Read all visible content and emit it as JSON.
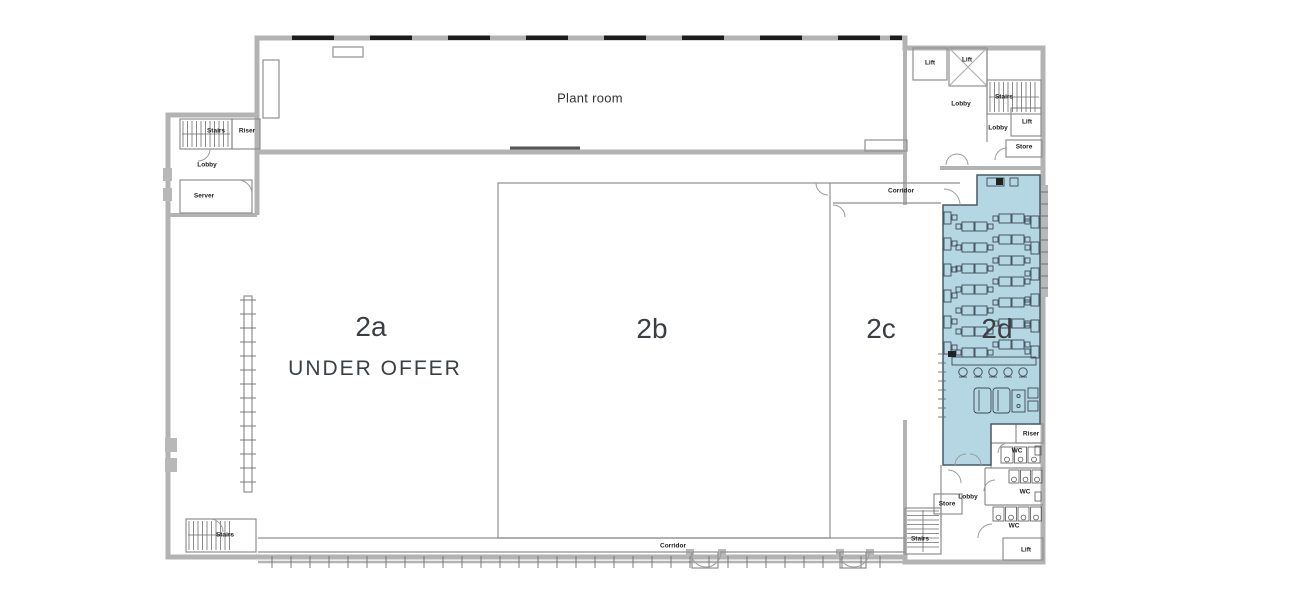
{
  "colors": {
    "highlight_fill": "#b5d7e4",
    "highlight_stroke": "#4a5a66",
    "wall": "#b3b3b3",
    "line": "#8f8f8f",
    "window_tick": "#1c1c1c",
    "text": "#3a3f44"
  },
  "zones": [
    {
      "id": "2a",
      "label": "2a",
      "sublabel": "UNDER OFFER",
      "x": 371,
      "y": 327,
      "sub_x": 375,
      "sub_y": 369,
      "highlighted": false
    },
    {
      "id": "2b",
      "label": "2b",
      "x": 652,
      "y": 329,
      "highlighted": false
    },
    {
      "id": "2c",
      "label": "2c",
      "x": 881,
      "y": 329,
      "highlighted": false
    },
    {
      "id": "2d",
      "label": "2d",
      "x": 997,
      "y": 329,
      "highlighted": true
    }
  ],
  "rooms": [
    {
      "label": "Stairs",
      "x": 216,
      "y": 131
    },
    {
      "label": "Riser",
      "x": 247,
      "y": 131
    },
    {
      "label": "Lobby",
      "x": 207,
      "y": 165
    },
    {
      "label": "Server",
      "x": 204,
      "y": 196
    },
    {
      "label": "Plant room",
      "x": 590,
      "y": 98,
      "big": true
    },
    {
      "label": "Lift",
      "x": 930,
      "y": 63
    },
    {
      "label": "Lift",
      "x": 967,
      "y": 60
    },
    {
      "label": "Lobby",
      "x": 961,
      "y": 104
    },
    {
      "label": "Stairs",
      "x": 1004,
      "y": 97
    },
    {
      "label": "Lobby",
      "x": 998,
      "y": 128
    },
    {
      "label": "Lift",
      "x": 1027,
      "y": 122
    },
    {
      "label": "Store",
      "x": 1024,
      "y": 147
    },
    {
      "label": "Corridor",
      "x": 901,
      "y": 191
    },
    {
      "label": "Riser",
      "x": 1031,
      "y": 434
    },
    {
      "label": "WC",
      "x": 1017,
      "y": 451
    },
    {
      "label": "WC",
      "x": 1025,
      "y": 492
    },
    {
      "label": "WC",
      "x": 1014,
      "y": 526
    },
    {
      "label": "Lobby",
      "x": 968,
      "y": 497
    },
    {
      "label": "Store",
      "x": 947,
      "y": 504
    },
    {
      "label": "Stairs",
      "x": 920,
      "y": 539
    },
    {
      "label": "Lift",
      "x": 1026,
      "y": 550
    },
    {
      "label": "Corridor",
      "x": 673,
      "y": 546
    },
    {
      "label": "Stairs",
      "x": 225,
      "y": 535
    }
  ]
}
